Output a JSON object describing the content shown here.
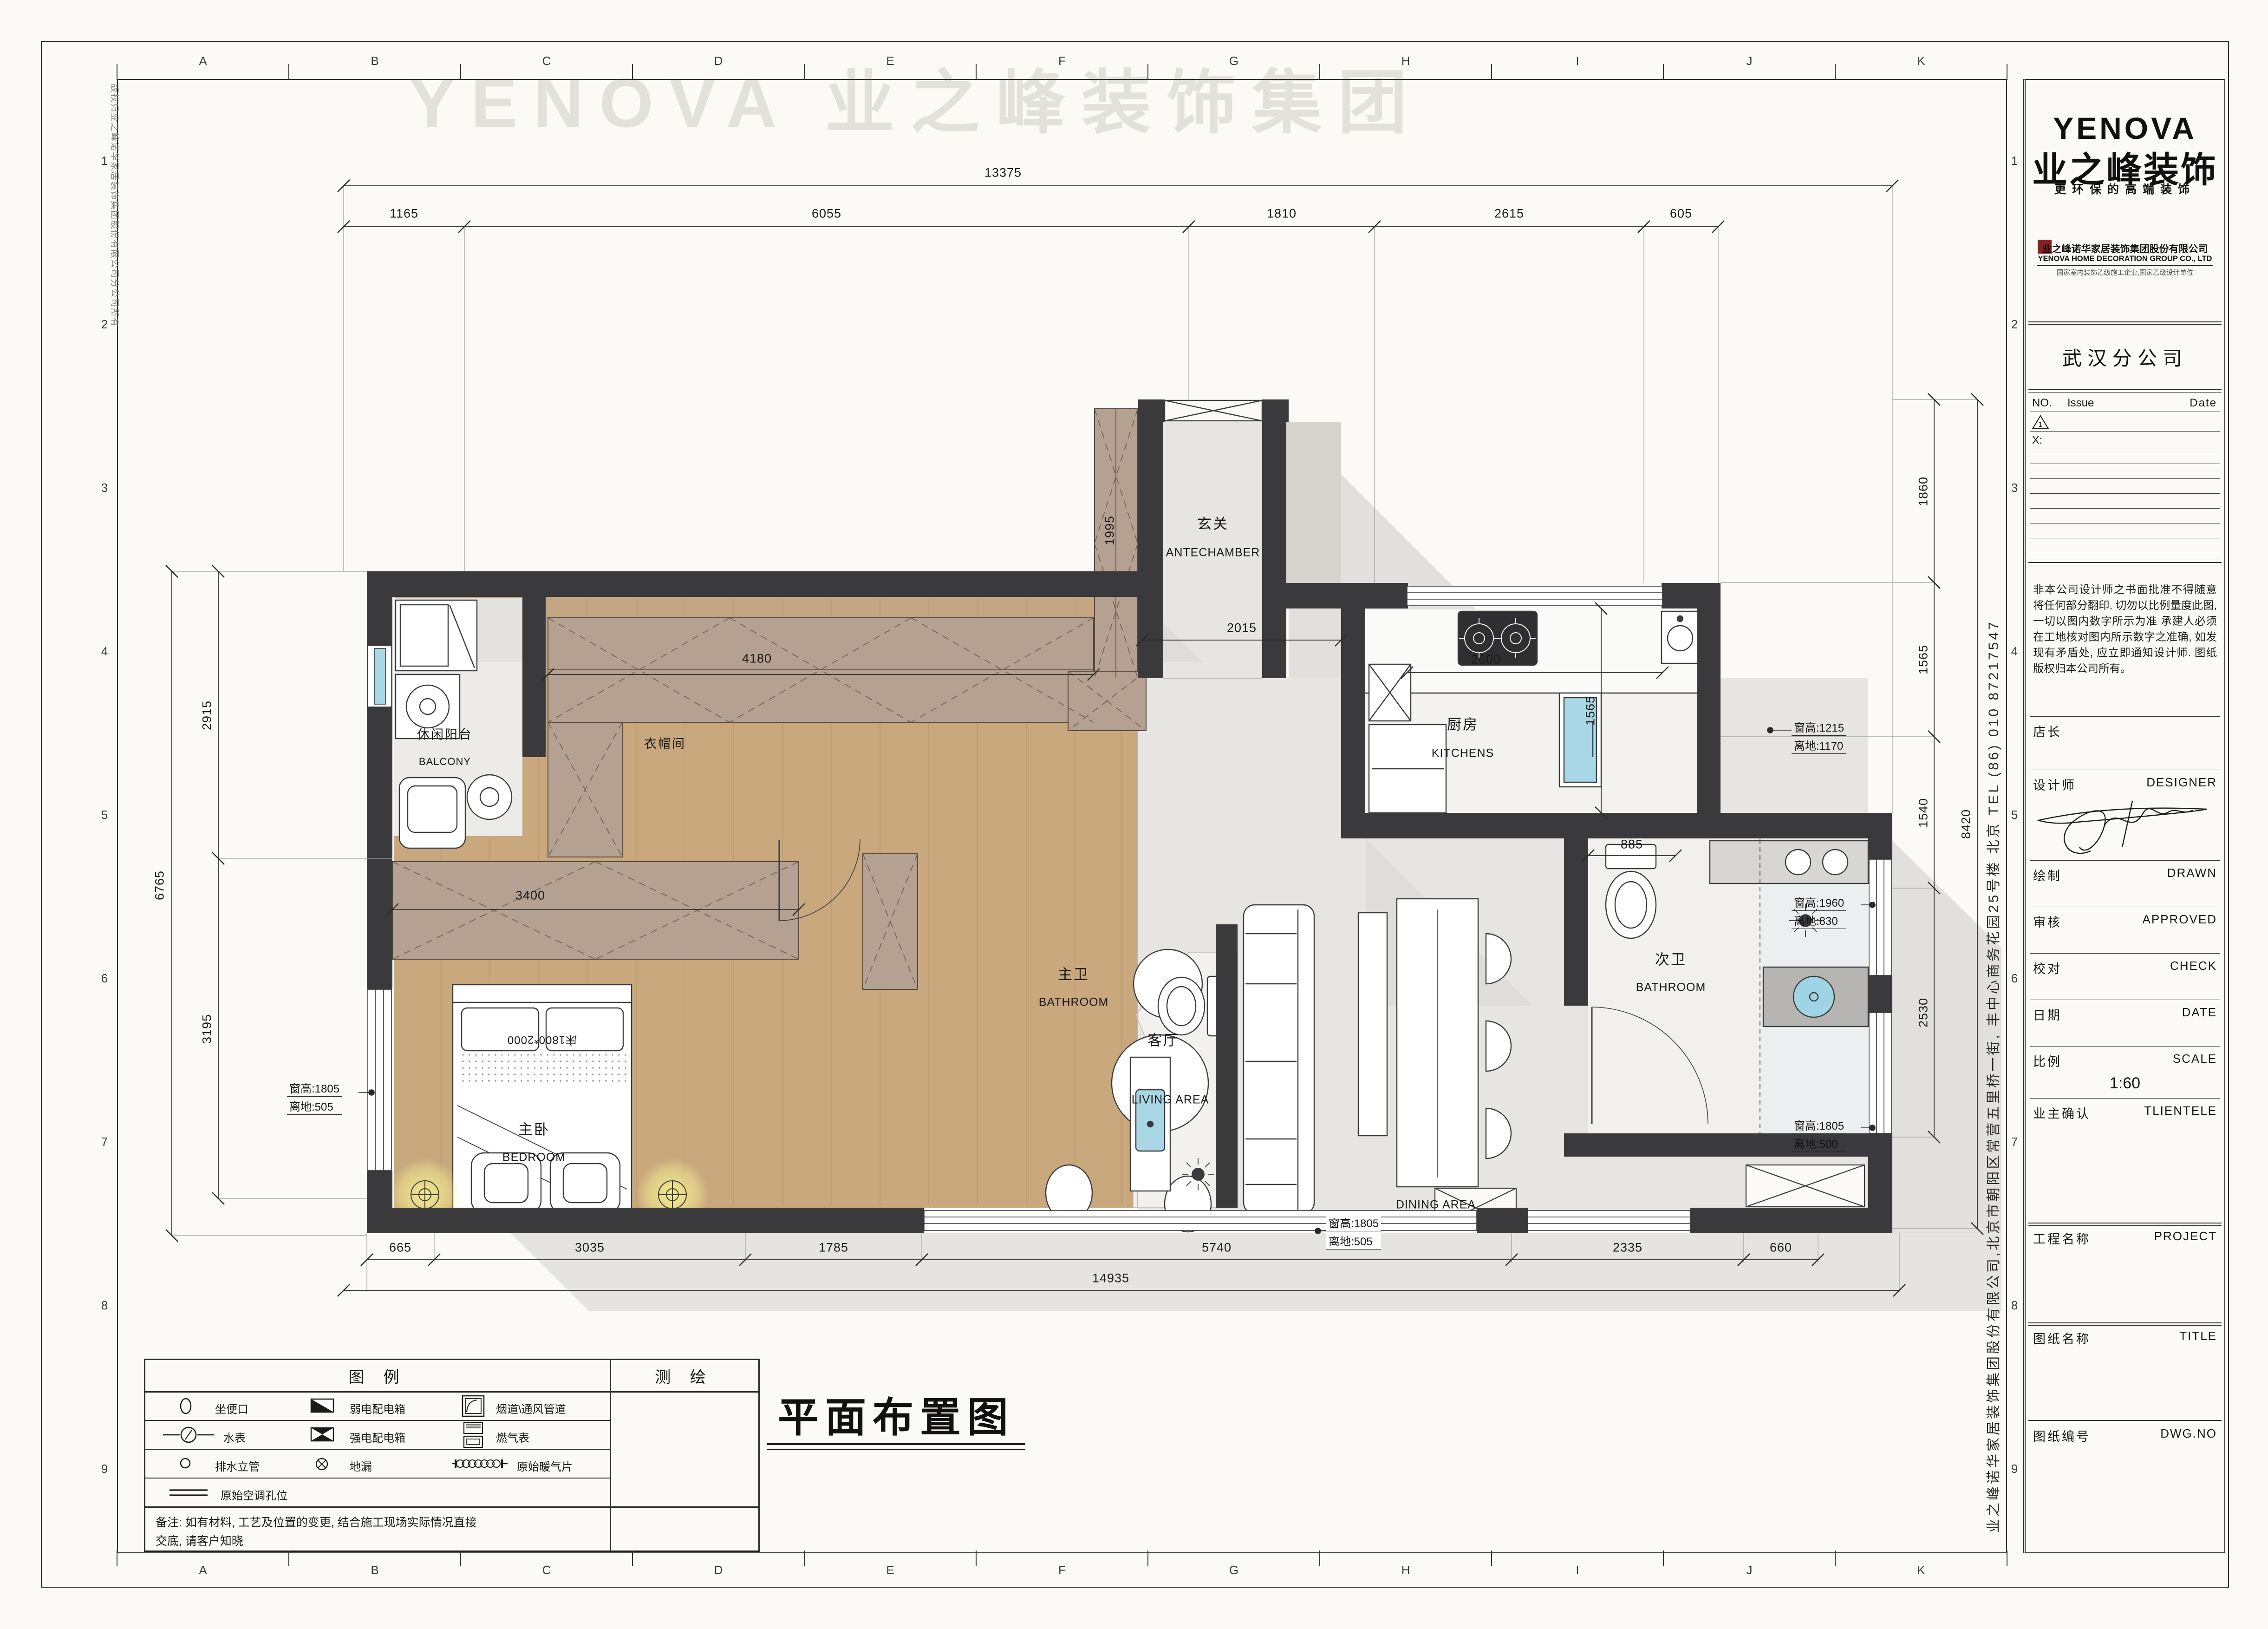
{
  "watermark": "YENOVA 业之峰装饰集团",
  "frame": {
    "letters": [
      "A",
      "B",
      "C",
      "D",
      "E",
      "F",
      "G",
      "H",
      "I",
      "J",
      "K"
    ],
    "numbers": [
      "1",
      "2",
      "3",
      "4",
      "5",
      "6",
      "7",
      "8",
      "9"
    ]
  },
  "side_texts": {
    "left_copyright": "版权归业之峰诺华家居装饰集团股份有限公司分公司所有",
    "right_address": "业之峰诺华家居装饰集团股份有限公司,北京市朝阳区常营五里桥一街, 丰中心商务花园25号楼  北京  TEL  (86) 010 87217547"
  },
  "drawing_title": "平面布置图",
  "title_block": {
    "logo_en": "YENOVA",
    "logo_cn": "业之峰装饰",
    "slogan": "更环保的高端装饰",
    "company_cn": "业之峰诺华家居装饰集团股份有限公司",
    "company_en": "YENOVA HOME DECORATION GROUP CO., LTD",
    "credential": "国家室内装饰乙级施工企业,国家乙级设计单位",
    "branch": "武汉分公司",
    "rev_no": "NO.",
    "rev_issue": "Issue",
    "rev_date": "Date",
    "rev_mark": "1",
    "rev_x": "X:",
    "disclaimer": "非本公司设计师之书面批准不得随意将任何部分翻印. 切勿以比例量度此图, 一切以图内数字所示为准 承建人必须在工地核对图内所示数字之准确, 如发现有矛盾处, 应立即通知设计师. 图纸版权归本公司所有。",
    "r_manager": "店长",
    "r_designer_cn": "设计师",
    "r_designer_en": "DESIGNER",
    "r_drawn_cn": "绘制",
    "r_drawn_en": "DRAWN",
    "r_approved_cn": "审核",
    "r_approved_en": "APPROVED",
    "r_check_cn": "校对",
    "r_check_en": "CHECK",
    "r_date_cn": "日期",
    "r_date_en": "DATE",
    "r_scale_cn": "比例",
    "r_scale_en": "SCALE",
    "scale_value": "1:60",
    "r_client_cn": "业主确认",
    "r_client_en": "TLIENTELE",
    "r_project_cn": "工程名称",
    "r_project_en": "PROJECT",
    "r_title_cn": "图纸名称",
    "r_title_en": "TITLE",
    "r_dwg_cn": "图纸编号",
    "r_dwg_en": "DWG.NO"
  },
  "legend": {
    "header": "图  例",
    "survey": "测  绘",
    "i1": "坐便口",
    "i2": "弱电配电箱",
    "i3": "烟道\\通风管道",
    "i4": "水表",
    "i5": "强电配电箱",
    "i6": "燃气表",
    "i7": "排水立管",
    "i8": "地漏",
    "i9": "原始暖气片",
    "i10": "原始空调孔位",
    "note1": "备注: 如有材料, 工艺及位置的变更, 结合施工现场实际情况直接",
    "note2": "交底, 请客户知晓"
  },
  "plan": {
    "rooms": {
      "entry_cn": "玄关",
      "entry_en": "ANTECHAMBER",
      "kitchen_cn": "厨房",
      "kitchen_en": "KITCHENS",
      "bath2_cn": "次卫",
      "bath2_en": "BATHROOM",
      "bath1_cn": "主卫",
      "bath1_en": "BATHROOM",
      "bed_cn": "主卧",
      "bed_en": "BEDROOM",
      "living_cn": "客厅",
      "living_en": "LIVING AREA",
      "dining_en": "DINING  AREA",
      "balcony_cn": "休闲阳台",
      "balcony_en": "BALCONY",
      "cloak_cn": "衣帽间"
    },
    "dims": {
      "top_total": "13375",
      "t1": "1165",
      "t2": "6055",
      "t3": "1810",
      "t4": "2615",
      "t5": "605",
      "bottom_total": "14935",
      "b1": "665",
      "b2": "3035",
      "b3": "1785",
      "b4": "5740",
      "b5": "2335",
      "b6": "660",
      "left_total": "6765",
      "l1": "2915",
      "l2": "3195",
      "right_total": "8420",
      "r1": "1860",
      "r2": "1565",
      "r3": "1540",
      "r4": "2530",
      "i_cloak": "4180",
      "i_entry": "2015",
      "i_ward": "1995",
      "i_kwin": "2600",
      "i_kdoor": "1565",
      "i_bath2": "885",
      "i_bedward": "3400",
      "bed": "床1800*2000"
    },
    "annotations": {
      "kwin1": "窗高:1215",
      "kwin2": "离地:1170",
      "bwin1": "窗高:1960",
      "bwin2": "离地:830",
      "rwin1": "窗高:1805",
      "rwin2": "离地:500",
      "botwin1": "窗高:1805",
      "botwin2": "离地:505",
      "lwin1": "窗高:1805",
      "lwin2": "离地:505"
    }
  }
}
